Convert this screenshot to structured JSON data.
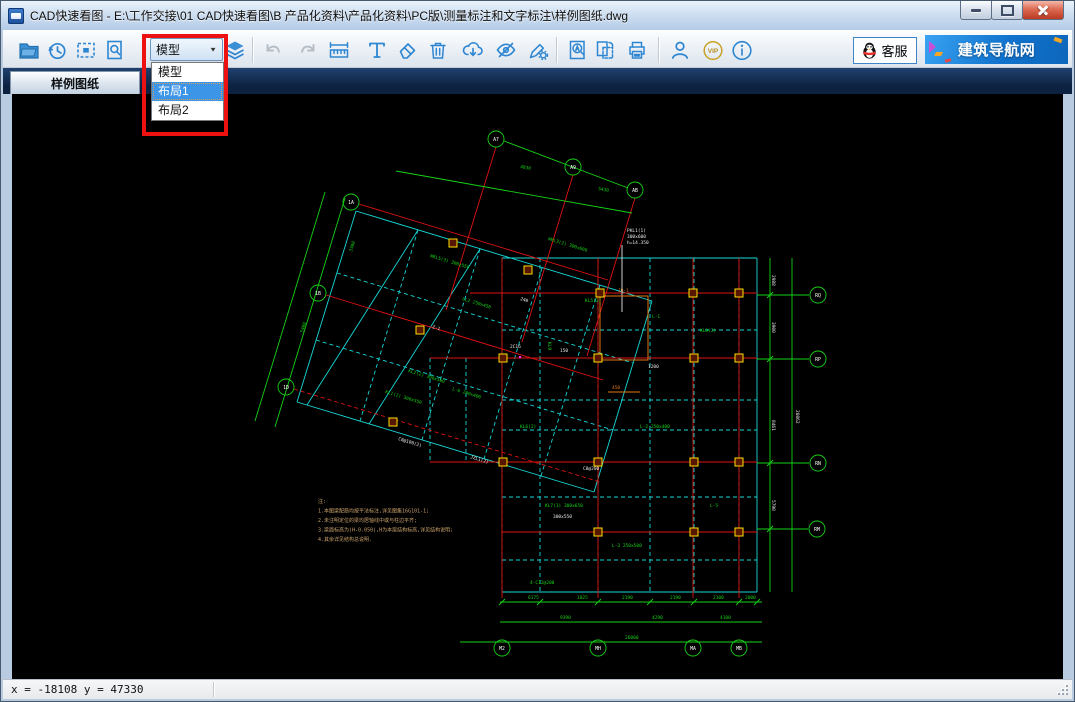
{
  "window": {
    "title": "CAD快速看图 - E:\\工作交接\\01 CAD快速看图\\B 产品化资料\\产品化资料\\PC版\\测量标注和文字标注\\样例图纸.dwg",
    "controls": [
      "minimize",
      "maximize",
      "close"
    ]
  },
  "toolbar": {
    "icons": [
      "open-folder",
      "history-clock",
      "fit-extents",
      "zoom-page",
      "layout-dropdown",
      "layers",
      "undo",
      "redo",
      "measure-ruler",
      "text-annotate",
      "eraser",
      "trash",
      "cloud-download",
      "hide-eye",
      "pen-settings",
      "find-text",
      "page-layout",
      "print",
      "user",
      "vip",
      "info"
    ],
    "vip_label": "VIP",
    "disabled_icons": [
      "undo",
      "redo"
    ]
  },
  "layout_dropdown": {
    "value": "模型",
    "arrow": "▼",
    "options": [
      {
        "label": "模型",
        "selected": false
      },
      {
        "label": "布局1",
        "selected": true
      },
      {
        "label": "布局2",
        "selected": false
      }
    ]
  },
  "top_right": {
    "support_label": "客服",
    "nav_label": "建筑导航网"
  },
  "tabs": [
    {
      "label": "样例图纸",
      "active": true
    }
  ],
  "statusbar": {
    "coords": "x = -18108 y = 47330"
  },
  "canvas": {
    "bg": "#000000",
    "colors": {
      "c": "#17d8d8",
      "r": "#e01212",
      "g": "#16d216",
      "w": "#e8e8e8",
      "o": "#e07818",
      "y": "#ffe000",
      "m": "#ff30ff",
      "t": "#c8a06a"
    },
    "lines": [
      [
        502,
        258,
        502,
        592,
        "c",
        1
      ],
      [
        540,
        258,
        540,
        592,
        "c",
        1
      ],
      [
        598,
        258,
        598,
        592,
        "c",
        1
      ],
      [
        650,
        258,
        650,
        592,
        "c",
        1
      ],
      [
        694,
        258,
        694,
        592,
        "c",
        1
      ],
      [
        739,
        258,
        739,
        592,
        "c",
        1
      ],
      [
        757,
        258,
        757,
        592,
        "c",
        0
      ],
      [
        502,
        258,
        757,
        258,
        "c",
        0
      ],
      [
        502,
        293,
        757,
        293,
        "c",
        1
      ],
      [
        502,
        330,
        757,
        330,
        "c",
        1
      ],
      [
        502,
        358,
        757,
        358,
        "c",
        1
      ],
      [
        502,
        400,
        757,
        400,
        "c",
        1
      ],
      [
        502,
        430,
        757,
        430,
        "c",
        1
      ],
      [
        502,
        462,
        757,
        462,
        "c",
        1
      ],
      [
        502,
        497,
        757,
        497,
        "c",
        1
      ],
      [
        502,
        532,
        757,
        532,
        "c",
        1
      ],
      [
        502,
        560,
        757,
        560,
        "c",
        1
      ],
      [
        502,
        592,
        757,
        592,
        "c",
        0
      ],
      [
        430,
        358,
        502,
        358,
        "c",
        1
      ],
      [
        430,
        462,
        502,
        462,
        "c",
        1
      ],
      [
        430,
        358,
        430,
        462,
        "c",
        1
      ],
      [
        466,
        358,
        466,
        462,
        "c",
        1
      ],
      [
        356,
        211,
        652,
        301,
        "c",
        0
      ],
      [
        652,
        301,
        594,
        492,
        "c",
        0
      ],
      [
        594,
        492,
        297,
        402,
        "c",
        0
      ],
      [
        297,
        402,
        356,
        211,
        "c",
        0
      ],
      [
        418,
        230,
        360,
        421,
        "c",
        1
      ],
      [
        480,
        249,
        422,
        440,
        "c",
        1
      ],
      [
        542,
        268,
        484,
        459,
        "c",
        1
      ],
      [
        600,
        285,
        541,
        476,
        "c",
        1
      ],
      [
        337,
        273,
        633,
        363,
        "c",
        1
      ],
      [
        316,
        340,
        613,
        430,
        "c",
        1
      ],
      [
        418,
        230,
        307,
        405,
        "c",
        0
      ],
      [
        480,
        249,
        369,
        424,
        "c",
        0
      ],
      [
        470,
        293,
        757,
        293,
        "r",
        0
      ],
      [
        430,
        358,
        757,
        358,
        "r",
        0
      ],
      [
        430,
        462,
        757,
        462,
        "r",
        0
      ],
      [
        502,
        532,
        757,
        532,
        "r",
        0
      ],
      [
        502,
        258,
        502,
        598,
        "r",
        0
      ],
      [
        598,
        258,
        598,
        598,
        "r",
        0
      ],
      [
        693,
        258,
        693,
        598,
        "r",
        0
      ],
      [
        739,
        258,
        739,
        598,
        "r",
        0
      ],
      [
        496,
        147,
        446,
        310,
        "r",
        0
      ],
      [
        573,
        175,
        522,
        342,
        "r",
        0
      ],
      [
        635,
        198,
        587,
        356,
        "r",
        0
      ],
      [
        359,
        204,
        608,
        280,
        "r",
        0
      ],
      [
        326,
        295,
        603,
        380,
        "r",
        0
      ],
      [
        294,
        389,
        600,
        482,
        "r",
        1
      ],
      [
        500,
        602,
        762,
        602,
        "g",
        0
      ],
      [
        500,
        622,
        762,
        622,
        "g",
        0
      ],
      [
        460,
        642,
        762,
        642,
        "g",
        0
      ],
      [
        770,
        258,
        770,
        592,
        "g",
        0
      ],
      [
        792,
        258,
        792,
        592,
        "g",
        0
      ],
      [
        757,
        295,
        809,
        295,
        "g",
        0
      ],
      [
        757,
        359,
        809,
        359,
        "g",
        0
      ],
      [
        757,
        463,
        809,
        463,
        "g",
        0
      ],
      [
        757,
        529,
        808,
        529,
        "g",
        0
      ],
      [
        396,
        171,
        632,
        213,
        "g",
        0
      ],
      [
        504,
        141,
        628,
        188,
        "g",
        0
      ],
      [
        345,
        198,
        275,
        427,
        "g",
        0
      ],
      [
        325,
        192,
        255,
        421,
        "g",
        0
      ],
      [
        499,
        605,
        505,
        599,
        "g",
        0
      ],
      [
        537,
        605,
        543,
        599,
        "g",
        0
      ],
      [
        595,
        605,
        601,
        599,
        "g",
        0
      ],
      [
        647,
        605,
        653,
        599,
        "g",
        0
      ],
      [
        691,
        605,
        697,
        599,
        "g",
        0
      ],
      [
        736,
        605,
        742,
        599,
        "g",
        0
      ],
      [
        754,
        605,
        760,
        599,
        "g",
        0
      ],
      [
        767,
        298,
        773,
        292,
        "g",
        0
      ],
      [
        767,
        362,
        773,
        356,
        "g",
        0
      ],
      [
        767,
        466,
        773,
        460,
        "g",
        0
      ],
      [
        767,
        532,
        773,
        526,
        "g",
        0
      ],
      [
        622,
        245,
        622,
        312,
        "w",
        0
      ],
      [
        608,
        392,
        640,
        392,
        "o",
        0
      ]
    ],
    "rects": [
      [
        600,
        296,
        48,
        64,
        "o"
      ],
      [
        519,
        356,
        2,
        2,
        "m"
      ]
    ],
    "squares": [
      [
        600,
        293
      ],
      [
        693,
        293
      ],
      [
        739,
        293
      ],
      [
        503,
        358
      ],
      [
        598,
        358
      ],
      [
        694,
        358
      ],
      [
        739,
        358
      ],
      [
        503,
        462
      ],
      [
        598,
        462
      ],
      [
        694,
        462
      ],
      [
        739,
        462
      ],
      [
        598,
        532
      ],
      [
        694,
        532
      ],
      [
        739,
        532
      ],
      [
        453,
        243
      ],
      [
        528,
        270
      ],
      [
        420,
        330
      ],
      [
        393,
        422
      ]
    ],
    "bubbles": [
      [
        496,
        139,
        "A7"
      ],
      [
        573,
        167,
        "A9"
      ],
      [
        635,
        190,
        "AB"
      ],
      [
        351,
        202,
        "1A"
      ],
      [
        318,
        293,
        "1B"
      ],
      [
        286,
        387,
        "1D"
      ],
      [
        818,
        295,
        "RQ"
      ],
      [
        818,
        359,
        "RP"
      ],
      [
        818,
        463,
        "RN"
      ],
      [
        817,
        529,
        "RM"
      ],
      [
        502,
        648,
        "M2"
      ],
      [
        598,
        648,
        "MH"
      ],
      [
        693,
        648,
        "MA"
      ],
      [
        739,
        648,
        "MB"
      ]
    ],
    "texts": [
      [
        385,
        393,
        17,
        "KL1(2) 300x550",
        "g"
      ],
      [
        408,
        372,
        17,
        "KL2(2) 300x500",
        "g"
      ],
      [
        548,
        240,
        17,
        "WKL3(2) 300x600",
        "g"
      ],
      [
        462,
        300,
        17,
        "LL2 250x450",
        "g"
      ],
      [
        430,
        257,
        17,
        "WKL5(3) 300x550",
        "g"
      ],
      [
        452,
        390,
        17,
        "L-6 200x400",
        "g"
      ],
      [
        352,
        252,
        -73,
        "3300",
        "g"
      ],
      [
        303,
        333,
        -73,
        "5400",
        "g"
      ],
      [
        585,
        302,
        0,
        "KL5(2)",
        "g"
      ],
      [
        652,
        318,
        0,
        "L-1",
        "g"
      ],
      [
        520,
        428,
        0,
        "KL6(2)",
        "g"
      ],
      [
        545,
        507,
        0,
        "KL7(3) 300x650",
        "g"
      ],
      [
        612,
        547,
        0,
        "L-3 250x500",
        "g"
      ],
      [
        700,
        332,
        0,
        "KL8(2)",
        "g"
      ],
      [
        710,
        507,
        0,
        "L-5",
        "g"
      ],
      [
        640,
        428,
        0,
        "L-2 250x400",
        "g"
      ],
      [
        530,
        584,
        0,
        "4-C12@200",
        "g"
      ],
      [
        548,
        342,
        90,
        "KL9",
        "g"
      ],
      [
        528,
        599,
        0,
        "6175",
        "g"
      ],
      [
        577,
        599,
        0,
        "1025",
        "g"
      ],
      [
        622,
        599,
        0,
        "2190",
        "g"
      ],
      [
        670,
        599,
        0,
        "2190",
        "g"
      ],
      [
        713,
        599,
        0,
        "2100",
        "g"
      ],
      [
        745,
        599,
        0,
        "2000",
        "g"
      ],
      [
        560,
        619,
        0,
        "9390",
        "g"
      ],
      [
        652,
        619,
        0,
        "4290",
        "g"
      ],
      [
        720,
        619,
        0,
        "4100",
        "g"
      ],
      [
        625,
        639,
        0,
        "26000",
        "g"
      ],
      [
        520,
        168,
        10,
        "4830",
        "g"
      ],
      [
        598,
        190,
        10,
        "5430",
        "g"
      ],
      [
        627,
        232,
        0,
        "PKL1(1)",
        "w"
      ],
      [
        627,
        238,
        0,
        "300x600",
        "w"
      ],
      [
        627,
        244,
        0,
        "h=14.350",
        "w"
      ],
      [
        560,
        352,
        0,
        "150",
        "w"
      ],
      [
        470,
        458,
        17,
        "JZL1(2)",
        "w"
      ],
      [
        510,
        348,
        0,
        "2C16",
        "w"
      ],
      [
        583,
        470,
        0,
        "C8@200",
        "w"
      ],
      [
        648,
        368,
        0,
        "1200",
        "w"
      ],
      [
        432,
        328,
        17,
        "Z-1",
        "w"
      ],
      [
        553,
        518,
        0,
        "300x550",
        "w"
      ],
      [
        398,
        440,
        17,
        "C8@100(2)",
        "w"
      ],
      [
        520,
        300,
        17,
        "240",
        "w"
      ],
      [
        772,
        322,
        90,
        "3900",
        "w"
      ],
      [
        772,
        420,
        90,
        "8461",
        "w"
      ],
      [
        796,
        410,
        90,
        "20862",
        "w"
      ],
      [
        772,
        500,
        90,
        "5790",
        "w"
      ],
      [
        772,
        275,
        90,
        "2988",
        "w"
      ],
      [
        612,
        389,
        0,
        "450",
        "o"
      ],
      [
        618,
        292,
        0,
        "JD-1",
        "o"
      ]
    ],
    "notes": {
      "x": 318,
      "y": 503,
      "lh": 9.5,
      "size": 5,
      "lines": [
        "注:",
        "1.本图梁配筋均按平法标注,详见图集16G101-1;",
        "2.未注明定位的梁均居轴线中或与柱边平齐;",
        "3.梁面标高为(H-0.050),H为本层结构标高,详见结构说明;",
        "4.其余详见结构总说明."
      ]
    }
  }
}
